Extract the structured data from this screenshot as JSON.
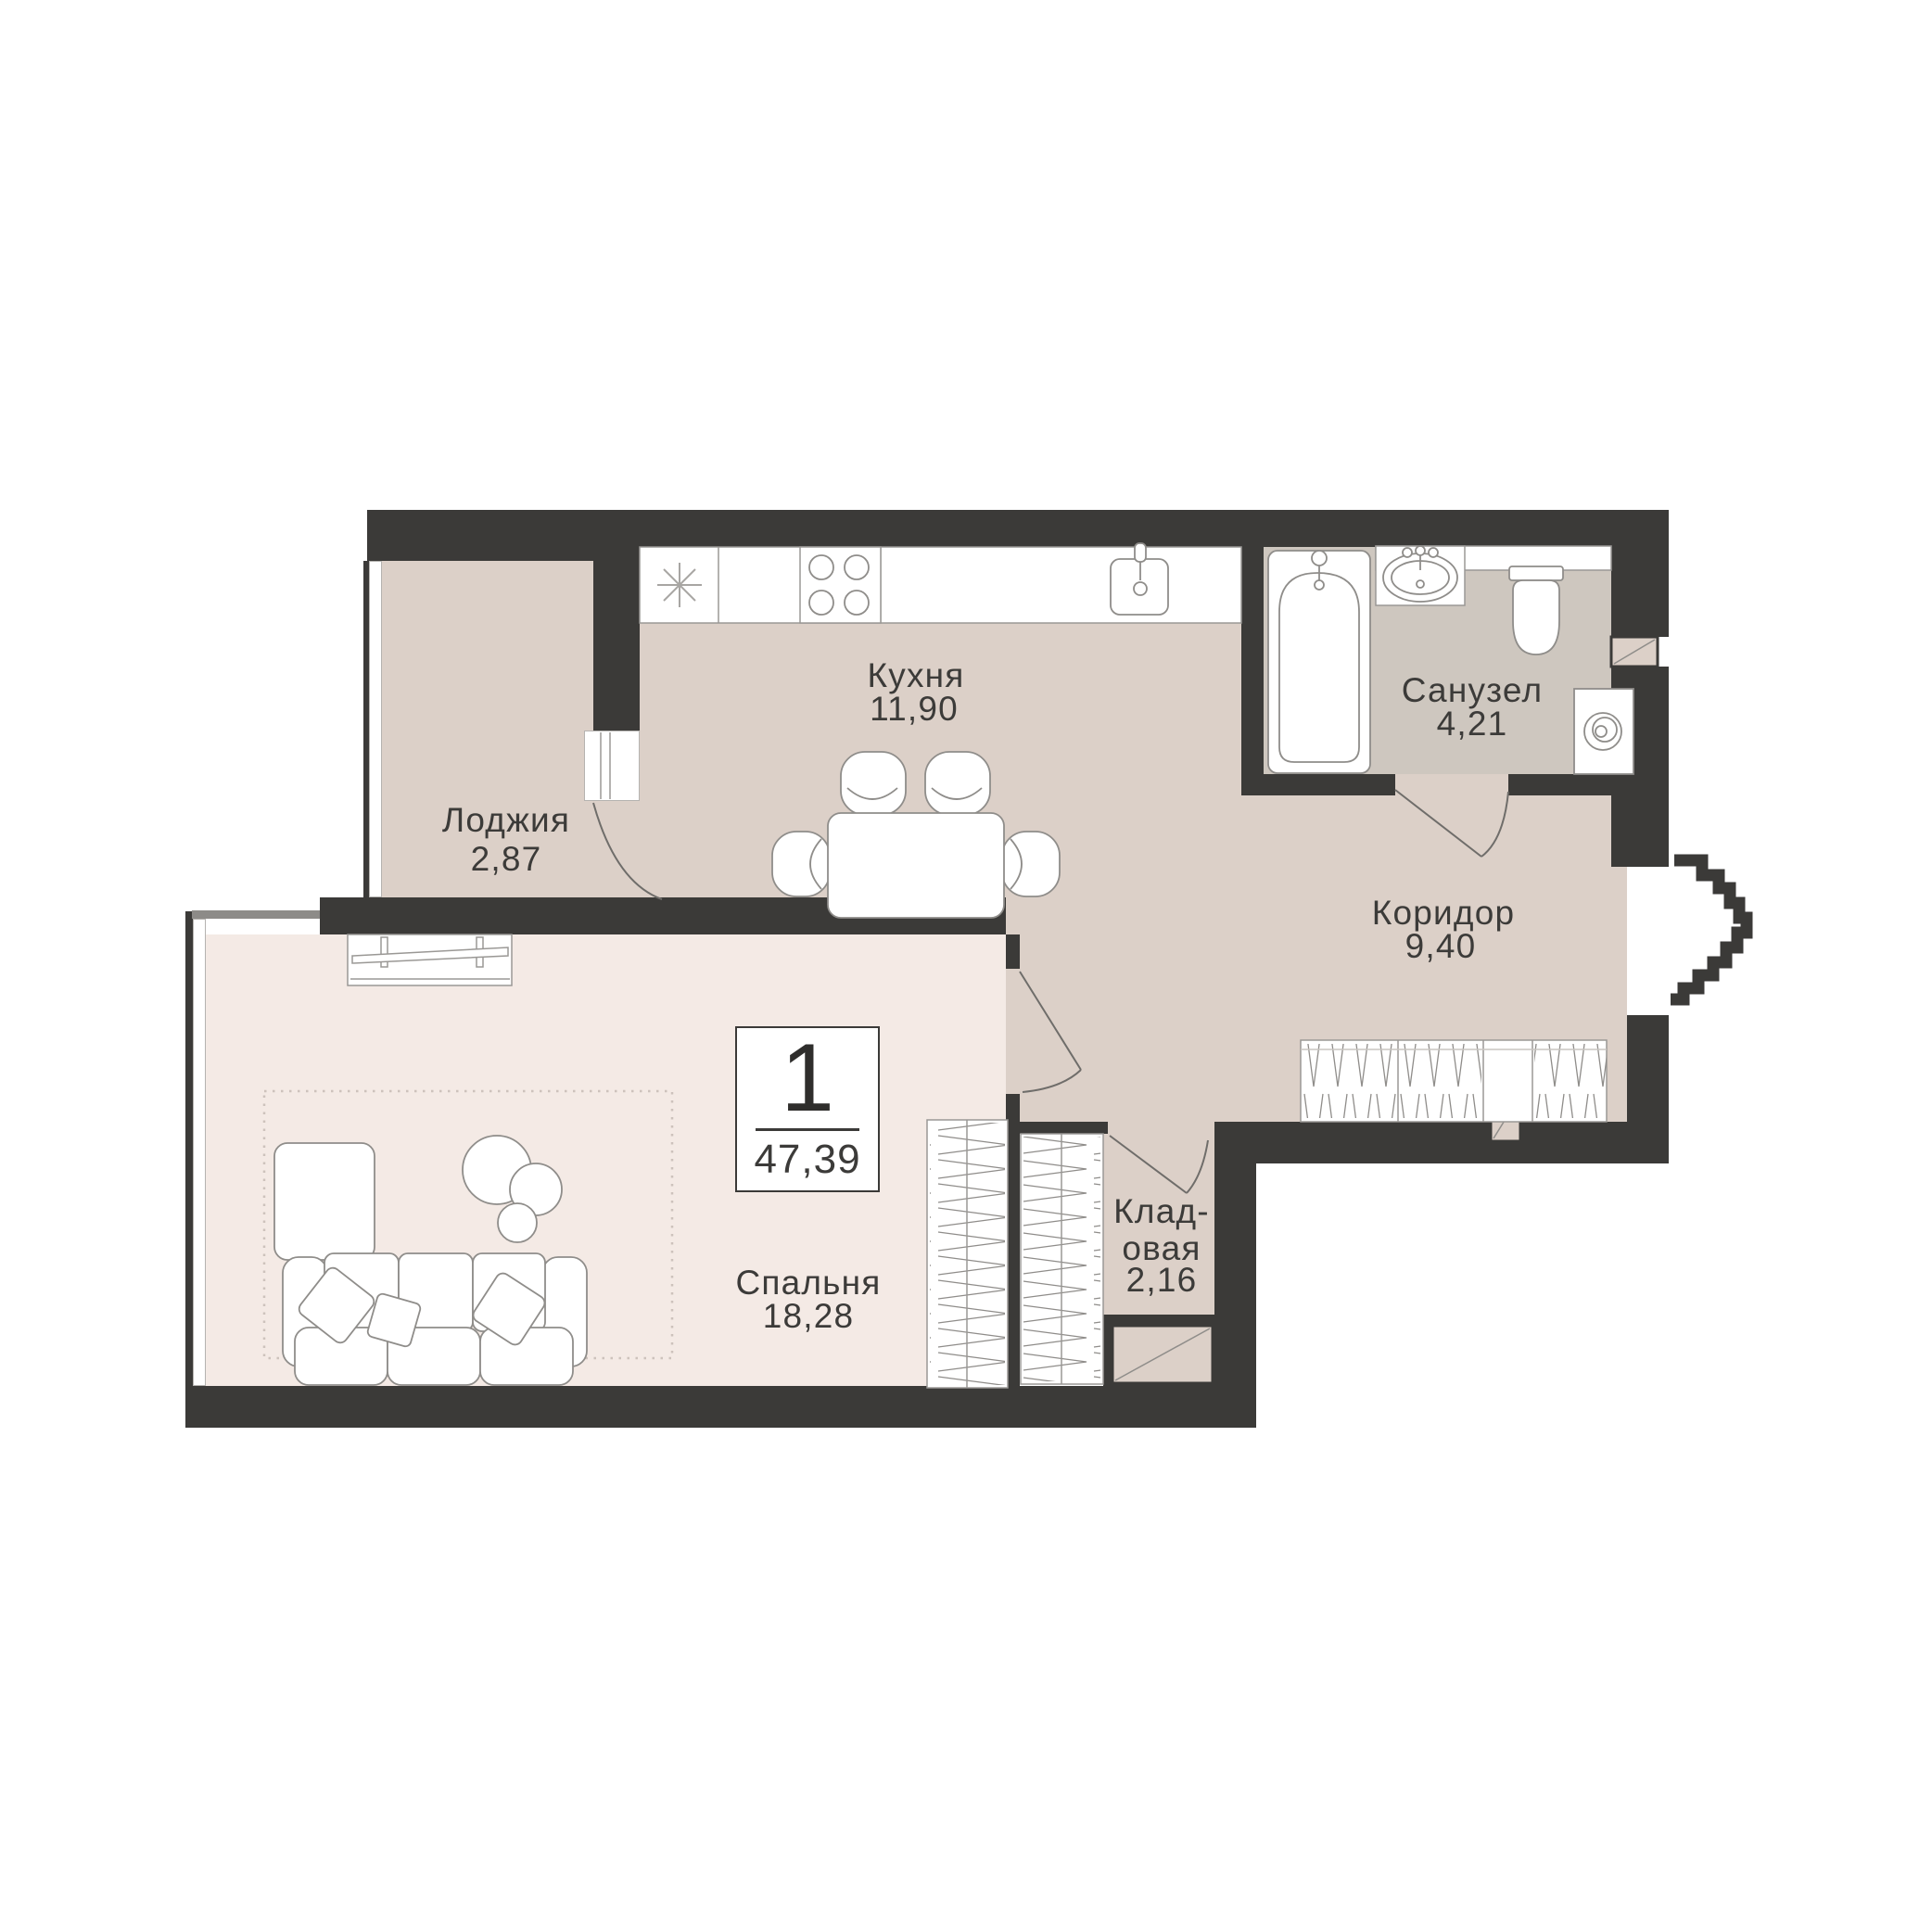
{
  "badge": {
    "rooms_count": "1",
    "total_area": "47,39"
  },
  "rooms": {
    "kitchen": {
      "name": "Кухня",
      "area": "11,90"
    },
    "loggia": {
      "name": "Лоджия",
      "area": "2,87"
    },
    "bathroom": {
      "name": "Санузел",
      "area": "4,21"
    },
    "corridor": {
      "name": "Коридор",
      "area": "9,40"
    },
    "storage": {
      "name_line1": "Клад-",
      "name_line2": "овая",
      "area": "2,16"
    },
    "bedroom": {
      "name": "Спальня",
      "area": "18,28"
    }
  },
  "colors": {
    "wall": "#3b3a38",
    "floor_main": "#dcd0c8",
    "floor_bathroom": "#cec7bf",
    "floor_bedroom": "#f4eae5",
    "outline": "#8f8d8a",
    "background": "#ffffff"
  }
}
